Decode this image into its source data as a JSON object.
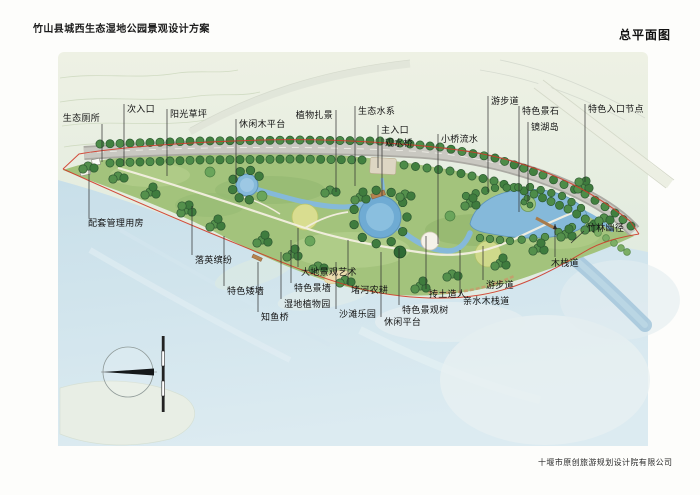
{
  "document": {
    "title": "竹山县城西生态湿地公园景观设计方案",
    "sheet_name": "总平面图",
    "company": "十堰市原创旅游规划设计院有限公司"
  },
  "plan": {
    "labels": [
      {
        "text": "生态厕所",
        "x": 100,
        "y": 114,
        "align": "right",
        "line": [
          102,
          124,
          162
        ]
      },
      {
        "text": "次入口",
        "x": 127,
        "y": 105,
        "line": [
          124,
          104,
          166
        ]
      },
      {
        "text": "阳光草坪",
        "x": 170,
        "y": 110,
        "line": [
          167,
          109,
          176
        ]
      },
      {
        "text": "休闲木平台",
        "x": 239,
        "y": 120,
        "line": [
          236,
          119,
          182
        ]
      },
      {
        "text": "植物扎景",
        "x": 333,
        "y": 111,
        "align": "right",
        "line": [
          336,
          110,
          192
        ]
      },
      {
        "text": "生态水系",
        "x": 358,
        "y": 107,
        "line": [
          355,
          106,
          186
        ]
      },
      {
        "text": "主入口",
        "x": 381,
        "y": 126,
        "line": [
          378,
          125,
          168
        ]
      },
      {
        "text": "观水桥",
        "x": 385,
        "y": 139,
        "line": [
          382,
          138,
          196
        ]
      },
      {
        "text": "小桥流水",
        "x": 441,
        "y": 135,
        "line": [
          438,
          134,
          244
        ]
      },
      {
        "text": "游步道",
        "x": 491,
        "y": 97,
        "line": [
          488,
          96,
          192
        ]
      },
      {
        "text": "特色景石",
        "x": 522,
        "y": 107,
        "line": [
          519,
          106,
          212
        ]
      },
      {
        "text": "镜湖岛",
        "x": 531,
        "y": 123,
        "line": [
          528,
          122,
          202
        ]
      },
      {
        "text": "特色入口节点",
        "x": 588,
        "y": 105,
        "line": [
          585,
          104,
          182
        ]
      },
      {
        "text": "配套管理用房",
        "x": 88,
        "y": 219,
        "line": [
          89,
          170,
          218
        ]
      },
      {
        "text": "落英缤纷",
        "x": 195,
        "y": 256,
        "line": [
          192,
          206,
          255
        ]
      },
      {
        "text": "特色矮墙",
        "x": 227,
        "y": 287,
        "line": [
          224,
          236,
          286
        ]
      },
      {
        "text": "大地景观艺术",
        "x": 301,
        "y": 268,
        "line": [
          298,
          228,
          267
        ]
      },
      {
        "text": "特色景墙",
        "x": 294,
        "y": 284,
        "line": [
          291,
          240,
          283
        ]
      },
      {
        "text": "湿地植物园",
        "x": 284,
        "y": 300,
        "line": [
          281,
          252,
          299
        ]
      },
      {
        "text": "知鱼桥",
        "x": 261,
        "y": 313,
        "line": [
          258,
          262,
          312
        ]
      },
      {
        "text": "沙滩乐园",
        "x": 339,
        "y": 310,
        "line": [
          336,
          262,
          309
        ]
      },
      {
        "text": "堵河农耕",
        "x": 351,
        "y": 286,
        "line": [
          348,
          240,
          285
        ]
      },
      {
        "text": "抟土造人",
        "x": 429,
        "y": 290,
        "line": [
          426,
          236,
          289
        ]
      },
      {
        "text": "特色景观树",
        "x": 402,
        "y": 306,
        "line": [
          399,
          248,
          305
        ]
      },
      {
        "text": "休闲平台",
        "x": 384,
        "y": 318,
        "line": [
          381,
          252,
          317
        ]
      },
      {
        "text": "亲水木栈道",
        "x": 463,
        "y": 297,
        "line": [
          460,
          250,
          296
        ]
      },
      {
        "text": "游步道",
        "x": 486,
        "y": 281,
        "line": [
          483,
          246,
          280
        ]
      },
      {
        "text": "木栈道",
        "x": 551,
        "y": 259,
        "line": [
          555,
          224,
          257
        ],
        "arrow": true
      },
      {
        "text": "竹林幽径",
        "x": 587,
        "y": 224,
        "seg": [
          584,
          231,
          571,
          243
        ]
      }
    ],
    "colors": {
      "boundary_red": "#cf3b2a",
      "water_blue": "#85b9da",
      "park_green": "#a3c37c",
      "road_gray": "#abaaa3"
    }
  },
  "icons": {
    "compass": "north-compass-icon",
    "scale_bar": "scale-bar"
  }
}
